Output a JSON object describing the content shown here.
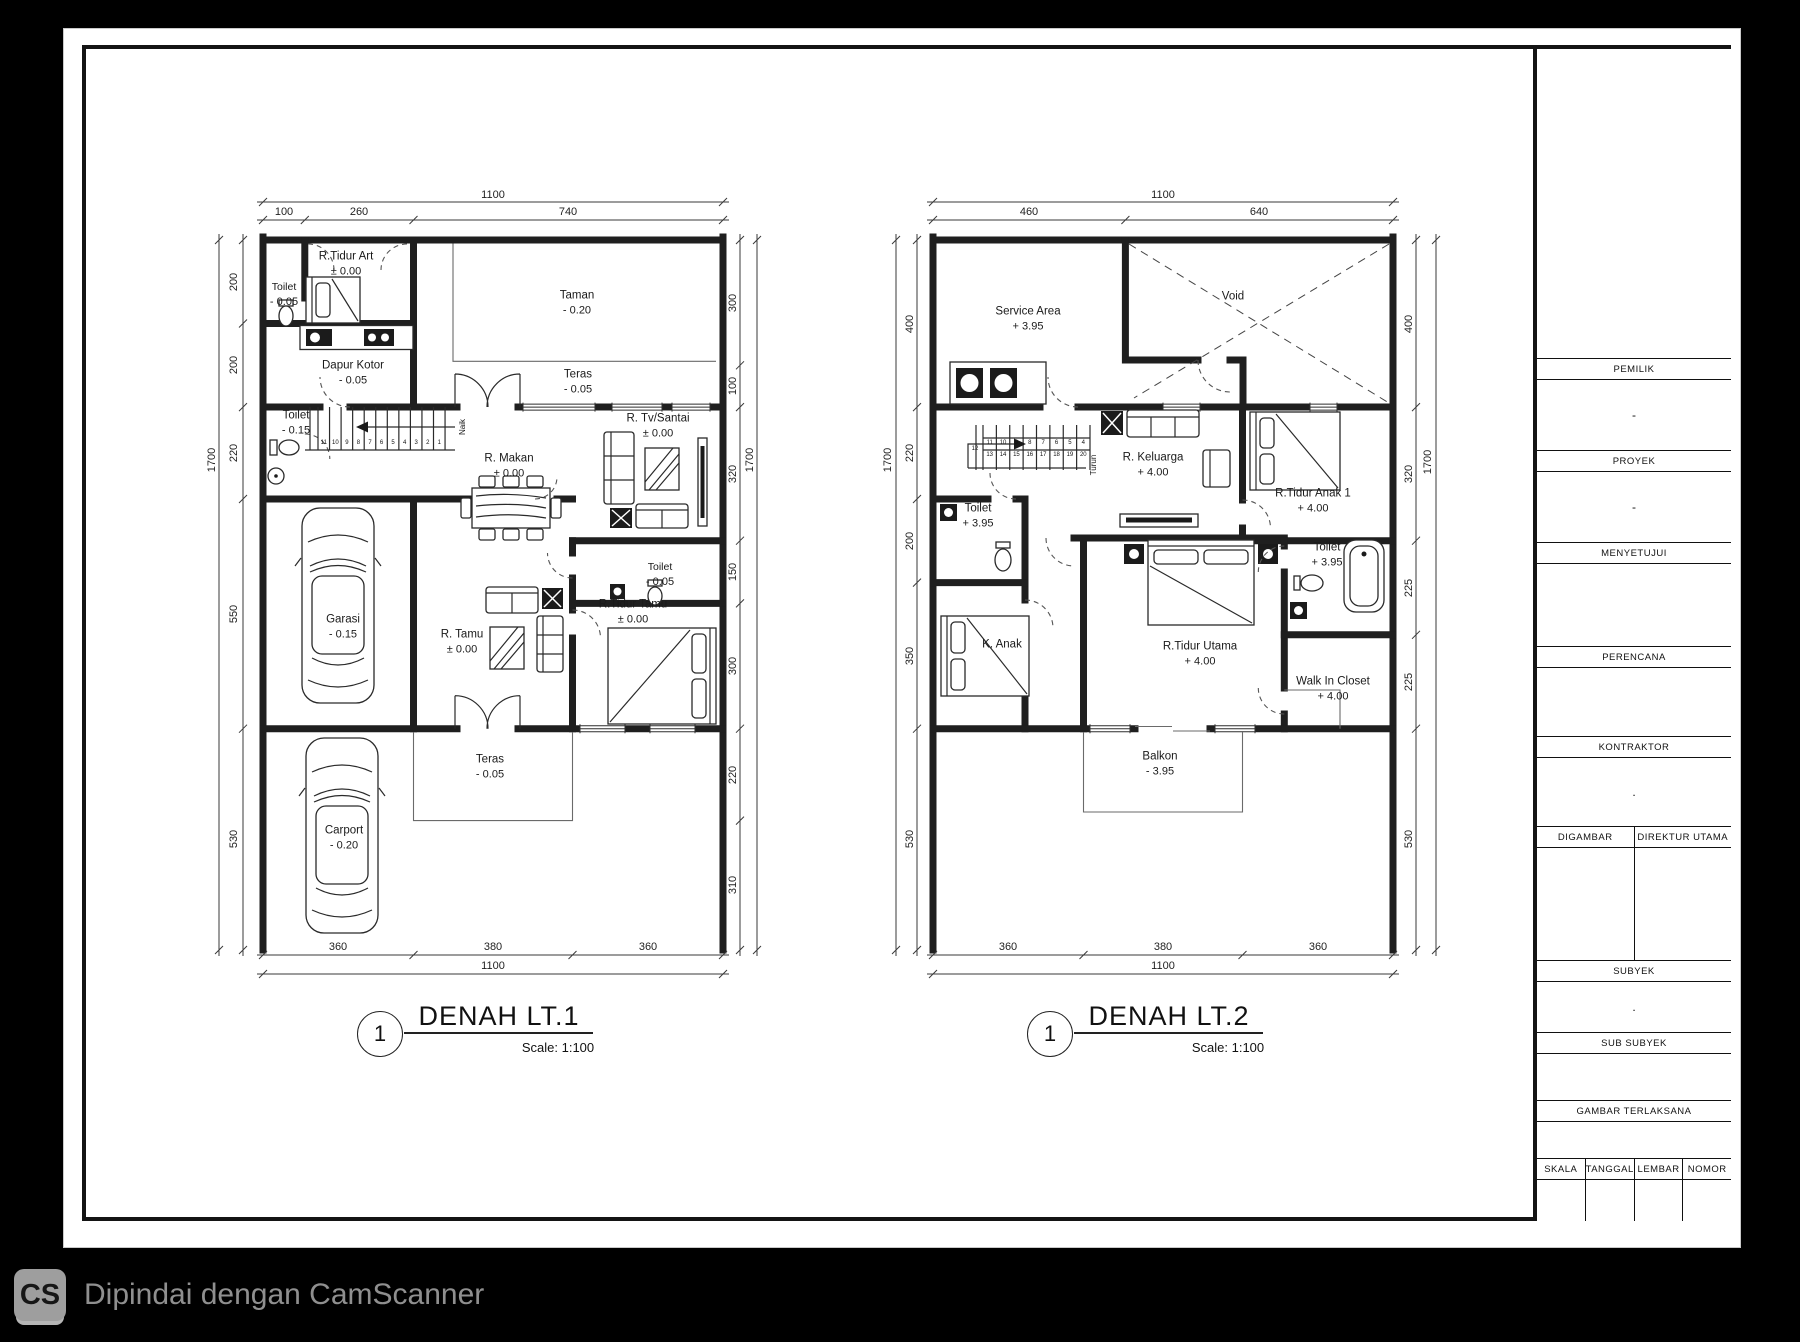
{
  "footer": {
    "logo": "CS",
    "text": "Dipindai dengan CamScanner"
  },
  "plans": [
    {
      "title": {
        "bubble": "1",
        "name": "DENAH LT.1",
        "scale": "Scale: 1:100"
      },
      "labels": [
        {
          "text": "Toilet",
          "level": "- 0.05",
          "x": 284,
          "y": 295,
          "size": 10.5
        },
        {
          "text": "R.Tidur Art",
          "level": "± 0.00",
          "x": 346,
          "y": 264
        },
        {
          "text": "Taman",
          "level": "- 0.20",
          "x": 577,
          "y": 303
        },
        {
          "text": "Dapur Kotor",
          "level": "- 0.05",
          "x": 353,
          "y": 373
        },
        {
          "text": "Teras",
          "level": "- 0.05",
          "x": 578,
          "y": 382
        },
        {
          "text": "Toilet",
          "level": "- 0.15",
          "x": 296,
          "y": 423
        },
        {
          "text": "Naik",
          "x": 463,
          "y": 427,
          "rot": -90,
          "size": 8
        },
        {
          "text": "R. Makan",
          "level": "± 0.00",
          "x": 509,
          "y": 466
        },
        {
          "text": "R. Tv/Santai",
          "level": "± 0.00",
          "x": 658,
          "y": 426
        },
        {
          "text": "Toilet",
          "level": "- 0.05",
          "x": 660,
          "y": 575,
          "size": 10.5
        },
        {
          "text": "R.Tidur Tamu",
          "level": "± 0.00",
          "x": 633,
          "y": 612
        },
        {
          "text": "Garasi",
          "level": "- 0.15",
          "x": 343,
          "y": 627
        },
        {
          "text": "R. Tamu",
          "level": "± 0.00",
          "x": 462,
          "y": 642
        },
        {
          "text": "Teras",
          "level": "- 0.05",
          "x": 490,
          "y": 767
        },
        {
          "text": "Carport",
          "level": "- 0.20",
          "x": 344,
          "y": 838
        }
      ],
      "dims": [
        {
          "text": "1100",
          "x": 493,
          "y": 195
        },
        {
          "text": "100",
          "x": 284,
          "y": 212
        },
        {
          "text": "260",
          "x": 359,
          "y": 212
        },
        {
          "text": "740",
          "x": 568,
          "y": 212
        },
        {
          "text": "1700",
          "x": 212,
          "y": 460,
          "rot": -90
        },
        {
          "text": "200",
          "x": 234,
          "y": 282,
          "rot": -90
        },
        {
          "text": "200",
          "x": 234,
          "y": 365,
          "rot": -90
        },
        {
          "text": "220",
          "x": 234,
          "y": 453,
          "rot": -90
        },
        {
          "text": "550",
          "x": 234,
          "y": 614,
          "rot": -90
        },
        {
          "text": "530",
          "x": 234,
          "y": 839,
          "rot": -90
        },
        {
          "text": "300",
          "x": 733,
          "y": 303,
          "rot": -90
        },
        {
          "text": "100",
          "x": 733,
          "y": 386,
          "rot": -90
        },
        {
          "text": "320",
          "x": 733,
          "y": 474,
          "rot": -90
        },
        {
          "text": "150",
          "x": 733,
          "y": 572,
          "rot": -90
        },
        {
          "text": "300",
          "x": 733,
          "y": 666,
          "rot": -90
        },
        {
          "text": "220",
          "x": 733,
          "y": 775,
          "rot": -90
        },
        {
          "text": "310",
          "x": 733,
          "y": 885,
          "rot": -90
        },
        {
          "text": "1700",
          "x": 750,
          "y": 460,
          "rot": -90
        },
        {
          "text": "360",
          "x": 338,
          "y": 947
        },
        {
          "text": "380",
          "x": 493,
          "y": 947
        },
        {
          "text": "360",
          "x": 648,
          "y": 947
        },
        {
          "text": "1100",
          "x": 493,
          "y": 966
        }
      ],
      "stairs": [
        {
          "x": 323.8,
          "dx": 11.55,
          "y": 443,
          "nums": [
            "11",
            "10",
            "9",
            "8",
            "7",
            "6",
            "5",
            "4",
            "3",
            "2",
            "1"
          ]
        }
      ]
    },
    {
      "title": {
        "bubble": "1",
        "name": "DENAH LT.2",
        "scale": "Scale: 1:100"
      },
      "labels": [
        {
          "text": "Service Area",
          "level": "+ 3.95",
          "x": 1028,
          "y": 319
        },
        {
          "text": "Void",
          "x": 1233,
          "y": 297
        },
        {
          "text": "R. Keluarga",
          "level": "+ 4.00",
          "x": 1153,
          "y": 465
        },
        {
          "text": "Turun",
          "x": 1094,
          "y": 465,
          "rot": -90,
          "size": 8
        },
        {
          "text": "R.Tidur Anak 1",
          "level": "+ 4.00",
          "x": 1313,
          "y": 501
        },
        {
          "text": "Toilet",
          "level": "+ 3.95",
          "x": 978,
          "y": 516
        },
        {
          "text": "Toilet",
          "level": "+ 3.95",
          "x": 1327,
          "y": 555
        },
        {
          "text": "K. Anak",
          "x": 1002,
          "y": 645
        },
        {
          "text": "R.Tidur Utama",
          "level": "+ 4.00",
          "x": 1200,
          "y": 654
        },
        {
          "text": "Walk In Closet",
          "level": "+ 4.00",
          "x": 1333,
          "y": 689
        },
        {
          "text": "Balkon",
          "level": "- 3.95",
          "x": 1160,
          "y": 764
        }
      ],
      "dims": [
        {
          "text": "1100",
          "x": 1163,
          "y": 195
        },
        {
          "text": "460",
          "x": 1029,
          "y": 212
        },
        {
          "text": "640",
          "x": 1259,
          "y": 212
        },
        {
          "text": "1700",
          "x": 888,
          "y": 460,
          "rot": -90
        },
        {
          "text": "400",
          "x": 910,
          "y": 324,
          "rot": -90
        },
        {
          "text": "220",
          "x": 910,
          "y": 453,
          "rot": -90
        },
        {
          "text": "200",
          "x": 910,
          "y": 541,
          "rot": -90
        },
        {
          "text": "350",
          "x": 910,
          "y": 656,
          "rot": -90
        },
        {
          "text": "530",
          "x": 910,
          "y": 839,
          "rot": -90
        },
        {
          "text": "400",
          "x": 1409,
          "y": 324,
          "rot": -90
        },
        {
          "text": "320",
          "x": 1409,
          "y": 474,
          "rot": -90
        },
        {
          "text": "225",
          "x": 1409,
          "y": 588,
          "rot": -90
        },
        {
          "text": "225",
          "x": 1409,
          "y": 682,
          "rot": -90
        },
        {
          "text": "530",
          "x": 1409,
          "y": 839,
          "rot": -90
        },
        {
          "text": "1700",
          "x": 1428,
          "y": 462,
          "rot": -90
        },
        {
          "text": "360",
          "x": 1008,
          "y": 947
        },
        {
          "text": "380",
          "x": 1163,
          "y": 947
        },
        {
          "text": "360",
          "x": 1318,
          "y": 947
        },
        {
          "text": "1100",
          "x": 1163,
          "y": 966
        }
      ],
      "stairs": [
        {
          "x": 989.7,
          "dx": 13.375,
          "y": 443,
          "nums": [
            "11",
            "10",
            "9",
            "8",
            "7",
            "6",
            "5",
            "4"
          ]
        },
        {
          "x": 989.7,
          "dx": 13.375,
          "y": 455,
          "nums": [
            "13",
            "14",
            "15",
            "16",
            "17",
            "18",
            "19",
            "20"
          ]
        },
        {
          "x": 975,
          "dx": 0,
          "y": 449,
          "nums": [
            "12"
          ]
        }
      ]
    }
  ],
  "titleblock": {
    "sections": [
      {
        "header": "PEMILIK",
        "value": "-"
      },
      {
        "header": "PROYEK",
        "value": "-"
      },
      {
        "header": "MENYETUJUI",
        "value": ""
      },
      {
        "header": "PERENCANA",
        "value": ""
      },
      {
        "header": "KONTRAKTOR",
        "value": "."
      }
    ],
    "drafter": {
      "left": "DIGAMBAR",
      "right": "DIREKTUR UTAMA"
    },
    "subyek": {
      "header": "SUBYEK",
      "value": "."
    },
    "sub_subyek": {
      "header": "SUB SUBYEK",
      "value": ""
    },
    "gambar": {
      "header": "GAMBAR TERLAKSANA",
      "value": ""
    },
    "footer_cols": [
      "SKALA",
      "TANGGAL",
      "LEMBAR",
      "NOMOR"
    ]
  }
}
